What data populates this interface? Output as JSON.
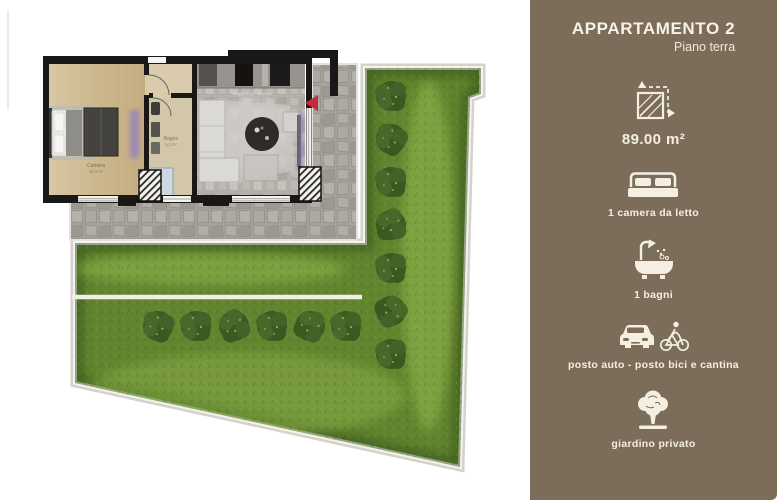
{
  "sidebar": {
    "title": "APPARTAMENTO 2",
    "subtitle": "Piano terra",
    "background_color": "#7b6d5a",
    "text_color": "#f5efe2",
    "features": [
      {
        "icon": "area-dimensions-icon",
        "label": "89.00 m²"
      },
      {
        "icon": "double-bed-icon",
        "label": "1 camera da letto"
      },
      {
        "icon": "bathtub-icon",
        "label": "1 bagni"
      },
      {
        "icon": "car-and-bicycle-icon",
        "label": "posto auto - posto bici e cantina"
      },
      {
        "icon": "tree-icon",
        "label": "giardino privato"
      }
    ]
  },
  "floorplan": {
    "rooms": [
      {
        "name": "Camera",
        "area": "16,4 m²"
      },
      {
        "name": "Bagno",
        "area": "5,2 m²"
      },
      {
        "name": "Soggiorno - Cucina",
        "area": "23,8 m²"
      }
    ],
    "colors": {
      "walls": "#1a1816",
      "wood_floor": "#cdb88e",
      "stone_patio": "#a6a29c",
      "grass": "#63852f",
      "hedge": "#3c5a21",
      "entrance_marker": "#c22b3d",
      "garden_border": "#f4f3ee"
    }
  }
}
